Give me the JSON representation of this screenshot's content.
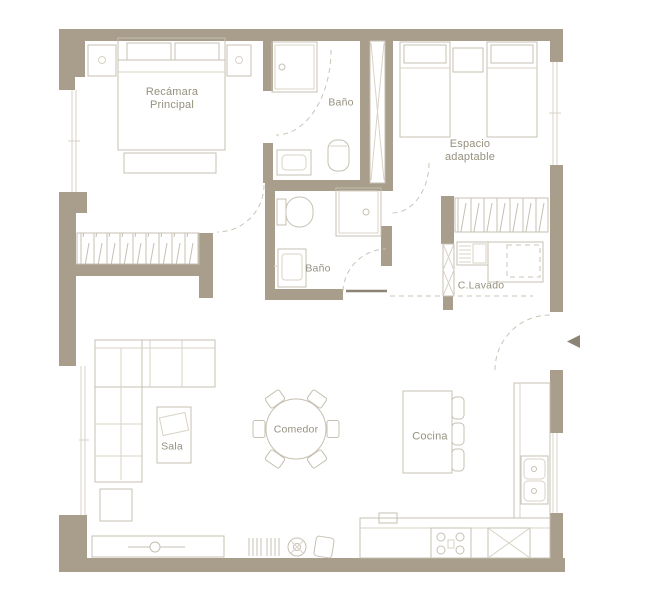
{
  "colors": {
    "bg": "#ffffff",
    "wall": "#a89e8b",
    "line": "#c6c0b2",
    "soft": "#d8d3c6",
    "label": "#95907e",
    "dash": "#cbc5b7",
    "arrow": "#8b8374"
  },
  "rooms": {
    "master_bedroom": {
      "label_line1": "Recámara",
      "label_line2": "Principal"
    },
    "bath_top": {
      "label": "Baño"
    },
    "adaptable_space": {
      "label_line1": "Espacio",
      "label_line2": "adaptable"
    },
    "bath_mid": {
      "label": "Baño"
    },
    "laundry": {
      "label": "C.Lavado"
    },
    "living_room": {
      "label": "Sala"
    },
    "dining_room": {
      "label": "Comedor"
    },
    "kitchen": {
      "label": "Cocina"
    }
  }
}
